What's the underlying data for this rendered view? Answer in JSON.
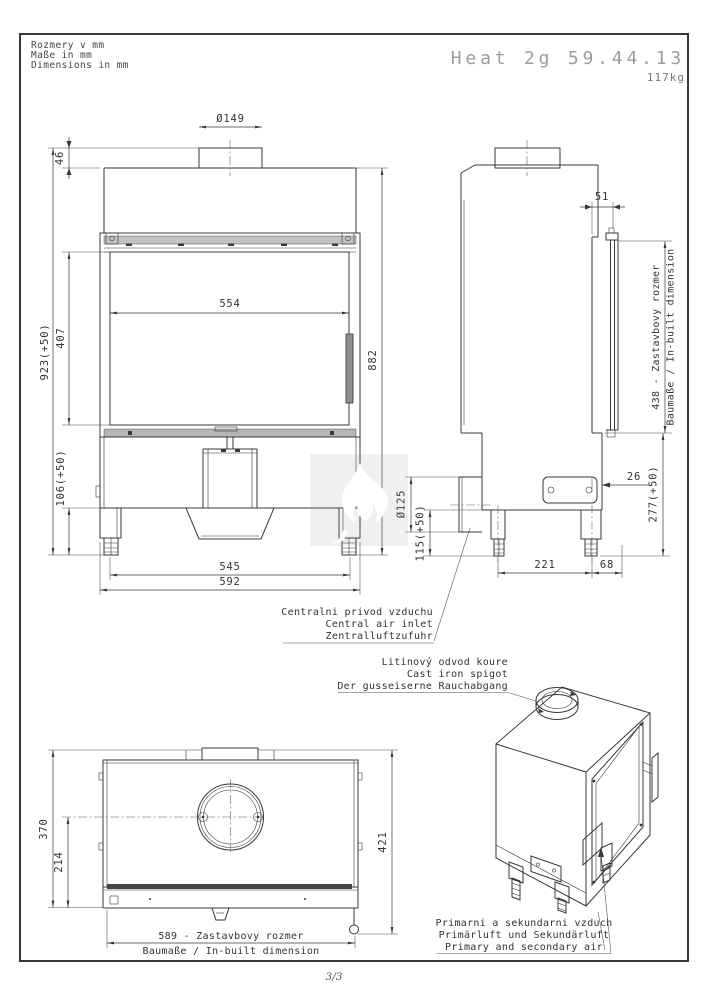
{
  "header": {
    "units": [
      "Rozmery v mm",
      "Maße in mm",
      "Dimensions in mm"
    ],
    "title": "Heat 2g 59.44.13",
    "weight": "117kg"
  },
  "front_view": {
    "flue_diameter": "Ø149",
    "collar_height": "46",
    "overall_height": "923(+50)",
    "glass_height": "407",
    "base_height": "106(+50)",
    "glass_width": "554",
    "body_height": "882",
    "feet_spacing": "545",
    "overall_width": "592"
  },
  "side_view": {
    "top_offset": "51",
    "inbuilt_depth": "438 - Zastavbovy rozmer",
    "inbuilt_depth_sub": "Baumaße / In-built dimension",
    "plinth_height": "277(+50)",
    "front_step": "26",
    "feet_spacing": "221",
    "rear_offset": "68",
    "air_inlet_diameter": "Ø125",
    "air_inlet_height": "115(+50)"
  },
  "plan_view": {
    "body_depth": "370",
    "flue_center_depth": "214",
    "overall_depth": "421",
    "inbuilt_width": "589 - Zastavbovy rozmer",
    "inbuilt_width_sub": "Baumaße / In-built dimension"
  },
  "notes": {
    "central_air": [
      "Centralni privod vzduchu",
      "Central air inlet",
      "Zentralluftzufuhr"
    ],
    "flue_spigot": [
      "Litinový odvod koure",
      "Cast iron spigot",
      "Der gusseiserne Rauchabgang"
    ],
    "primary_air": [
      "Primarni a sekundarni vzduch",
      "Primärluft und Sekundärluft",
      "Primary and secondary air"
    ]
  },
  "footer": {
    "page": "3/3"
  },
  "colors": {
    "line": "#383838",
    "title_grey": "#9c9c9c",
    "watermark_bg": "#ececec",
    "watermark_flame": "#ffffff"
  }
}
